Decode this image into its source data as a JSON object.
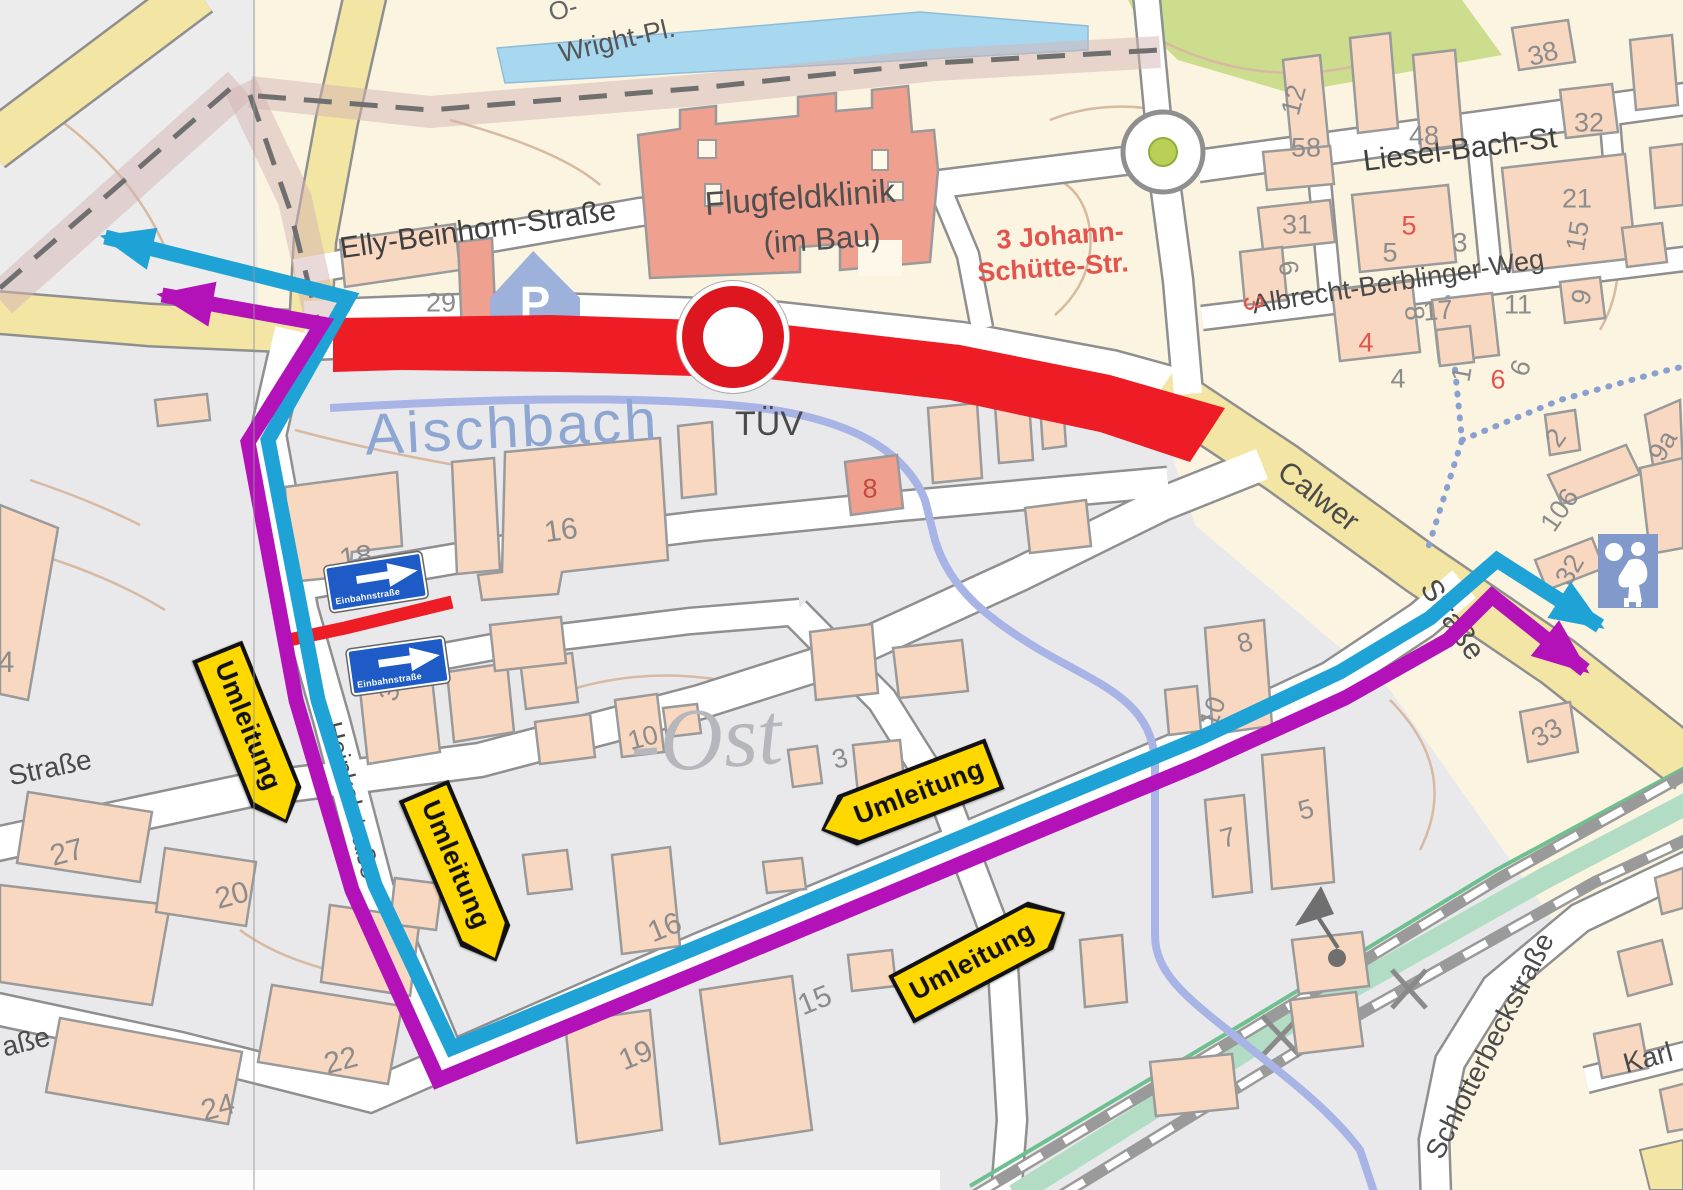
{
  "map": {
    "description": "Umleitungsplan – street map with road closure and signed detour routes",
    "colors": {
      "closure_red": "#ee1c25",
      "detour_cyan": "#1fa3d7",
      "detour_purple": "#b412b9",
      "sign_yellow": "#ffd800",
      "oneway_sign_blue": "#1e5bc6",
      "water_blue": "#a8d8ef",
      "stream_blue": "#a9b4e6",
      "building_salmon": "#f8d8c1",
      "road_yellow": "#f3e5a3"
    },
    "street_labels": [
      {
        "t": "O-",
        "x": 563,
        "y": 9,
        "r": -15,
        "s": 26,
        "c": "#666666"
      },
      {
        "t": "Wright-Pl.",
        "x": 617,
        "y": 41,
        "r": -13,
        "s": 27,
        "c": "#555555"
      },
      {
        "t": "Elly-Beinhorn-Straße",
        "x": 478,
        "y": 230,
        "r": -8,
        "s": 30
      },
      {
        "t": "Flugfeldklinik",
        "x": 800,
        "y": 197,
        "r": -4,
        "s": 33,
        "c": "#4f4f4f"
      },
      {
        "t": "(im Bau)",
        "x": 822,
        "y": 239,
        "r": -4,
        "s": 31,
        "c": "#4f4f4f"
      },
      {
        "t": "3  Johann-",
        "x": 1060,
        "y": 236,
        "r": -4,
        "s": 27,
        "c": "#e2544c",
        "b": 1
      },
      {
        "t": "Schütte-Str.",
        "x": 1053,
        "y": 268,
        "r": -4,
        "s": 27,
        "c": "#e2544c",
        "b": 1
      },
      {
        "t": "Liesel-Bach-St",
        "x": 1460,
        "y": 150,
        "r": -7,
        "s": 30
      },
      {
        "t": "Albrecht-Berblinger-Weg",
        "x": 1398,
        "y": 282,
        "r": -9,
        "s": 27,
        "c": "#4a4a4a"
      },
      {
        "t": "Aischbach",
        "x": 512,
        "y": 428,
        "r": -3,
        "s": 58,
        "c": "#8ea6d2",
        "ls": 3
      },
      {
        "t": "TÜV",
        "x": 769,
        "y": 424,
        "r": 0,
        "s": 34,
        "c": "#4a4a4a"
      },
      {
        "t": "430",
        "x": 1098,
        "y": 408,
        "r": -5,
        "s": 44,
        "c": "#e49a8c",
        "b": 1
      },
      {
        "t": "Calwer",
        "x": 1318,
        "y": 497,
        "r": 38,
        "s": 30,
        "c": "#4a4a4a"
      },
      {
        "t": "Straße",
        "x": 1452,
        "y": 620,
        "r": 56,
        "s": 30,
        "c": "#4a4a4a"
      },
      {
        "t": "Heinkelstraße",
        "x": 352,
        "y": 800,
        "r": 76,
        "s": 26,
        "c": "#4a4a4a"
      },
      {
        "t": "-Ost",
        "x": 706,
        "y": 740,
        "r": -4,
        "s": 88,
        "c": "#b6b6bd",
        "f": "serif",
        "i": 1
      },
      {
        "t": "Straße",
        "x": 50,
        "y": 768,
        "r": -12,
        "s": 28,
        "c": "#4a4a4a"
      },
      {
        "t": "aße",
        "x": 26,
        "y": 1042,
        "r": -14,
        "s": 28,
        "c": "#4a4a4a"
      },
      {
        "t": "Schlotterbeckstraße",
        "x": 1490,
        "y": 1046,
        "r": -63,
        "s": 28,
        "c": "#4a4a4a"
      },
      {
        "t": "Karl",
        "x": 1648,
        "y": 1058,
        "r": -15,
        "s": 28,
        "c": "#4a4a4a"
      }
    ],
    "house_numbers": [
      {
        "t": "29",
        "x": 441,
        "y": 303
      },
      {
        "t": "38",
        "x": 1543,
        "y": 54,
        "r": -15
      },
      {
        "t": "12",
        "x": 1294,
        "y": 100,
        "r": -75
      },
      {
        "t": "58",
        "x": 1306,
        "y": 148
      },
      {
        "t": "48",
        "x": 1424,
        "y": 136
      },
      {
        "t": "32",
        "x": 1589,
        "y": 123
      },
      {
        "t": "31",
        "x": 1297,
        "y": 225
      },
      {
        "t": "5",
        "x": 1409,
        "y": 226,
        "c": "#e2544c"
      },
      {
        "t": "5",
        "x": 1390,
        "y": 253
      },
      {
        "t": "3",
        "x": 1460,
        "y": 243
      },
      {
        "t": "21",
        "x": 1577,
        "y": 199
      },
      {
        "t": "15",
        "x": 1578,
        "y": 236,
        "r": -80
      },
      {
        "t": "6",
        "x": 1288,
        "y": 268,
        "r": 80
      },
      {
        "t": "17",
        "x": 1438,
        "y": 311,
        "r": -5
      },
      {
        "t": "8",
        "x": 1414,
        "y": 313,
        "r": 85
      },
      {
        "t": "11",
        "x": 1518,
        "y": 305
      },
      {
        "t": "9",
        "x": 1582,
        "y": 297,
        "r": -75
      },
      {
        "t": "3",
        "x": 1253,
        "y": 303,
        "r": 80,
        "c": "#e2544c"
      },
      {
        "t": "4",
        "x": 1366,
        "y": 343,
        "c": "#e2544c"
      },
      {
        "t": "4",
        "x": 1398,
        "y": 379
      },
      {
        "t": "1",
        "x": 1462,
        "y": 374,
        "r": -80
      },
      {
        "t": "6",
        "x": 1498,
        "y": 380,
        "c": "#e2544c"
      },
      {
        "t": "6",
        "x": 1521,
        "y": 368,
        "r": -70
      },
      {
        "t": "2",
        "x": 1556,
        "y": 438,
        "r": -55
      },
      {
        "t": "9a",
        "x": 1663,
        "y": 446,
        "r": -60
      },
      {
        "t": "106",
        "x": 1560,
        "y": 510,
        "r": -55
      },
      {
        "t": "32",
        "x": 1570,
        "y": 570,
        "r": -60
      },
      {
        "t": "33",
        "x": 1547,
        "y": 733,
        "r": -30
      },
      {
        "t": "8",
        "x": 870,
        "y": 489,
        "c": "#c14b3e"
      },
      {
        "t": "16",
        "x": 561,
        "y": 531,
        "r": -8,
        "s": 30
      },
      {
        "t": "18",
        "x": 356,
        "y": 558,
        "r": -8,
        "s": 30
      },
      {
        "t": "3",
        "x": 390,
        "y": 693,
        "r": -75
      },
      {
        "t": "10",
        "x": 643,
        "y": 738,
        "r": -15
      },
      {
        "t": "3",
        "x": 840,
        "y": 759,
        "r": -15
      },
      {
        "t": "8",
        "x": 1245,
        "y": 643,
        "r": -15
      },
      {
        "t": "10",
        "x": 1213,
        "y": 712,
        "r": -70
      },
      {
        "t": "16",
        "x": 665,
        "y": 928,
        "r": -22,
        "s": 30
      },
      {
        "t": "15",
        "x": 815,
        "y": 1001,
        "r": -22,
        "s": 30
      },
      {
        "t": "19",
        "x": 636,
        "y": 1056,
        "r": -22,
        "s": 30
      },
      {
        "t": "27",
        "x": 67,
        "y": 853,
        "r": -15,
        "s": 30
      },
      {
        "t": "20",
        "x": 232,
        "y": 896,
        "r": -15,
        "s": 30
      },
      {
        "t": "24",
        "x": 218,
        "y": 1108,
        "r": -15,
        "s": 30
      },
      {
        "t": "22",
        "x": 341,
        "y": 1061,
        "r": -15,
        "s": 30
      },
      {
        "t": "7",
        "x": 1228,
        "y": 838,
        "r": -15
      },
      {
        "t": "5",
        "x": 1306,
        "y": 810,
        "r": -15
      },
      {
        "t": "4",
        "x": 6,
        "y": 663,
        "r": 0,
        "s": 30
      }
    ],
    "signs": {
      "umleitung": {
        "label": "Umleitung",
        "instances": [
          {
            "x": 252,
            "y": 737,
            "r": 68,
            "tip": "right"
          },
          {
            "x": 460,
            "y": 876,
            "r": 67,
            "tip": "right"
          },
          {
            "x": 908,
            "y": 797,
            "r": -21,
            "tip": "left"
          },
          {
            "x": 983,
            "y": 956,
            "r": -28,
            "tip": "right"
          }
        ]
      },
      "einbahnstrasse": {
        "label": "Einbahnstraße",
        "instances": [
          {
            "x": 374,
            "y": 580,
            "r": -9
          },
          {
            "x": 396,
            "y": 664,
            "r": -8
          }
        ]
      },
      "no_entry_sign": {
        "x": 733,
        "y": 337
      }
    },
    "icons": {
      "parking": {
        "label": "P",
        "x": 535,
        "y": 293
      },
      "playground": {
        "x": 1628,
        "y": 571
      }
    }
  }
}
